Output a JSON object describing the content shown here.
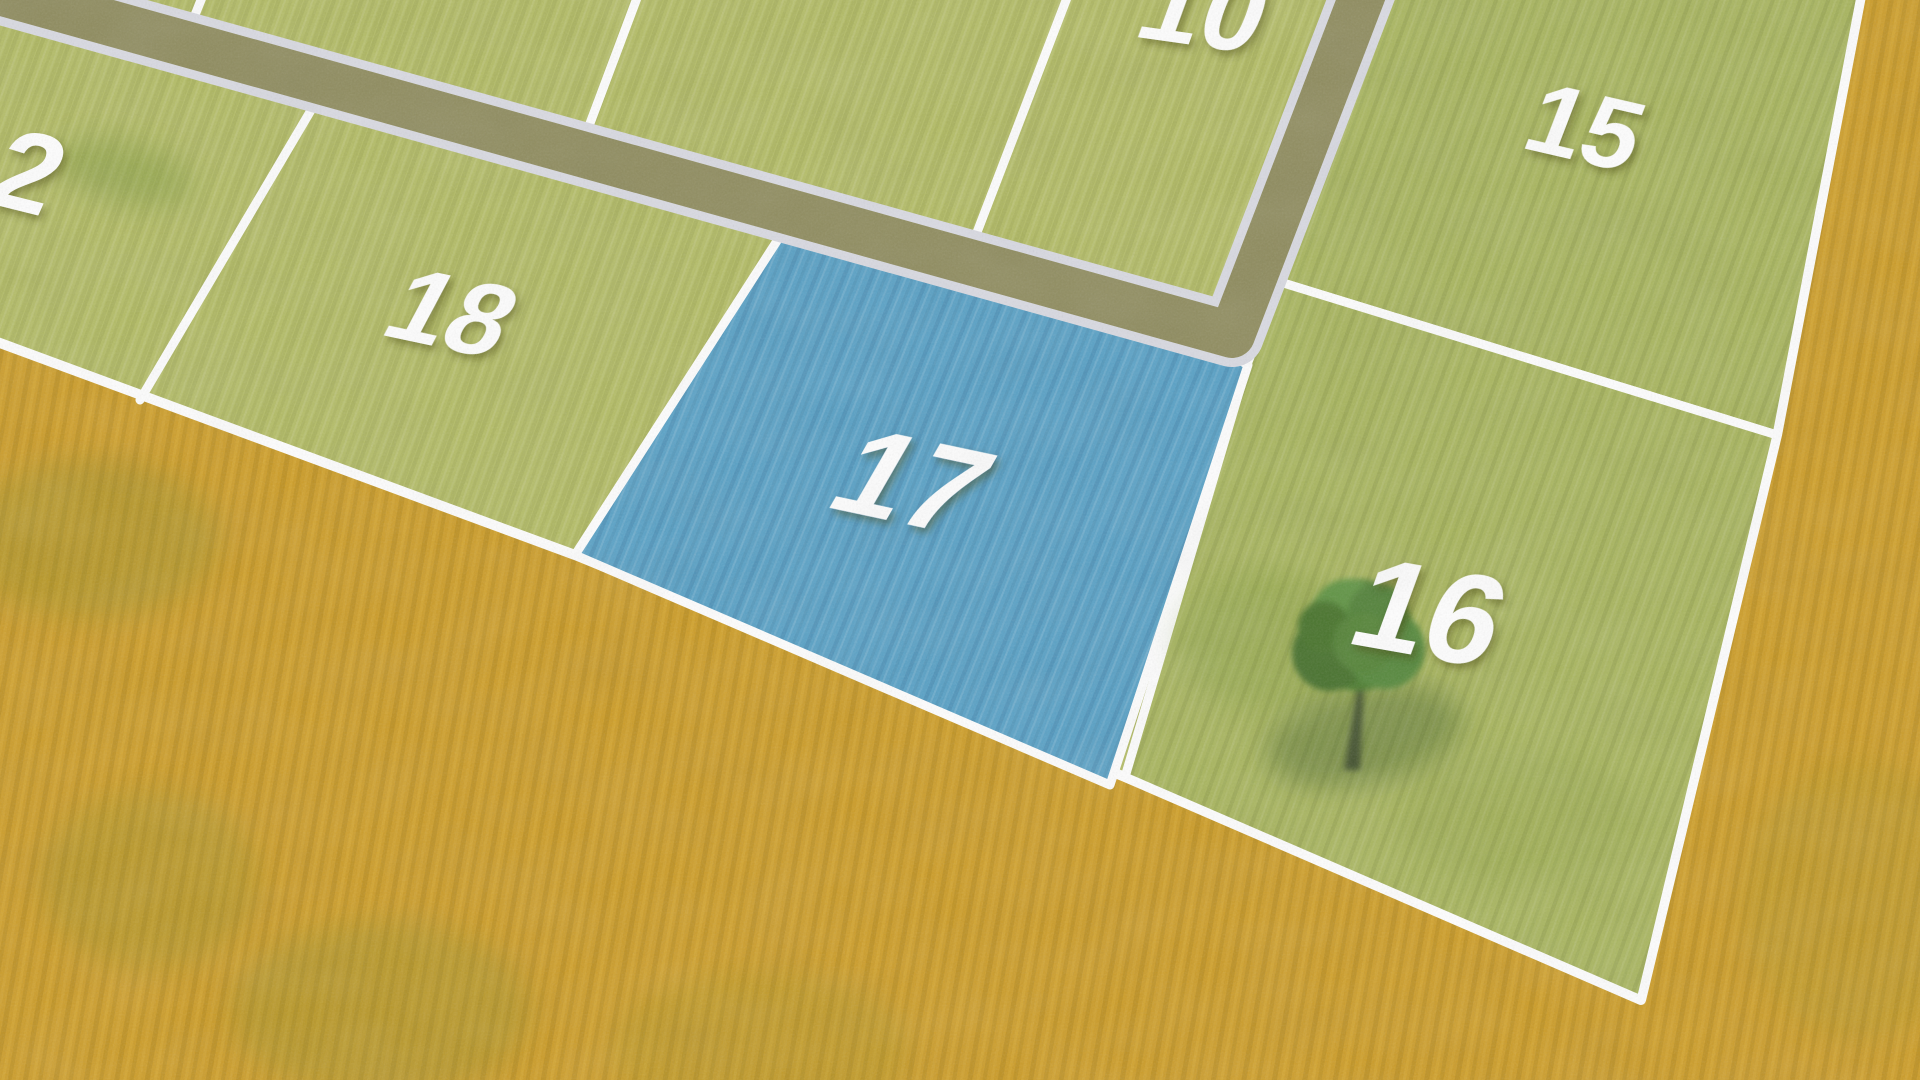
{
  "plots": [
    {
      "label": "2",
      "fill": "#b4bd66",
      "highlighted": false
    },
    {
      "label": "10",
      "fill": "#b4bd66",
      "highlighted": false
    },
    {
      "label": "15",
      "fill": "#a9b65e",
      "highlighted": false
    },
    {
      "label": "16",
      "fill": "#a9b65e",
      "highlighted": false
    },
    {
      "label": "17",
      "fill": "#58a1c6",
      "highlighted": true
    },
    {
      "label": "18",
      "fill": "#b4bd66",
      "highlighted": false
    }
  ],
  "highlighted_plot": "17",
  "tree": {
    "plot_label": "16"
  },
  "colors": {
    "field": "#cd9d28",
    "plot_green": "#b4bd66",
    "plot_green_dark": "#a9b65e",
    "highlight_blue": "#58a1c6",
    "road_surface": "#8f8c5e",
    "road_curb": "#dadbe3",
    "plot_border": "#ffffff",
    "label_text": "#ffffff"
  }
}
